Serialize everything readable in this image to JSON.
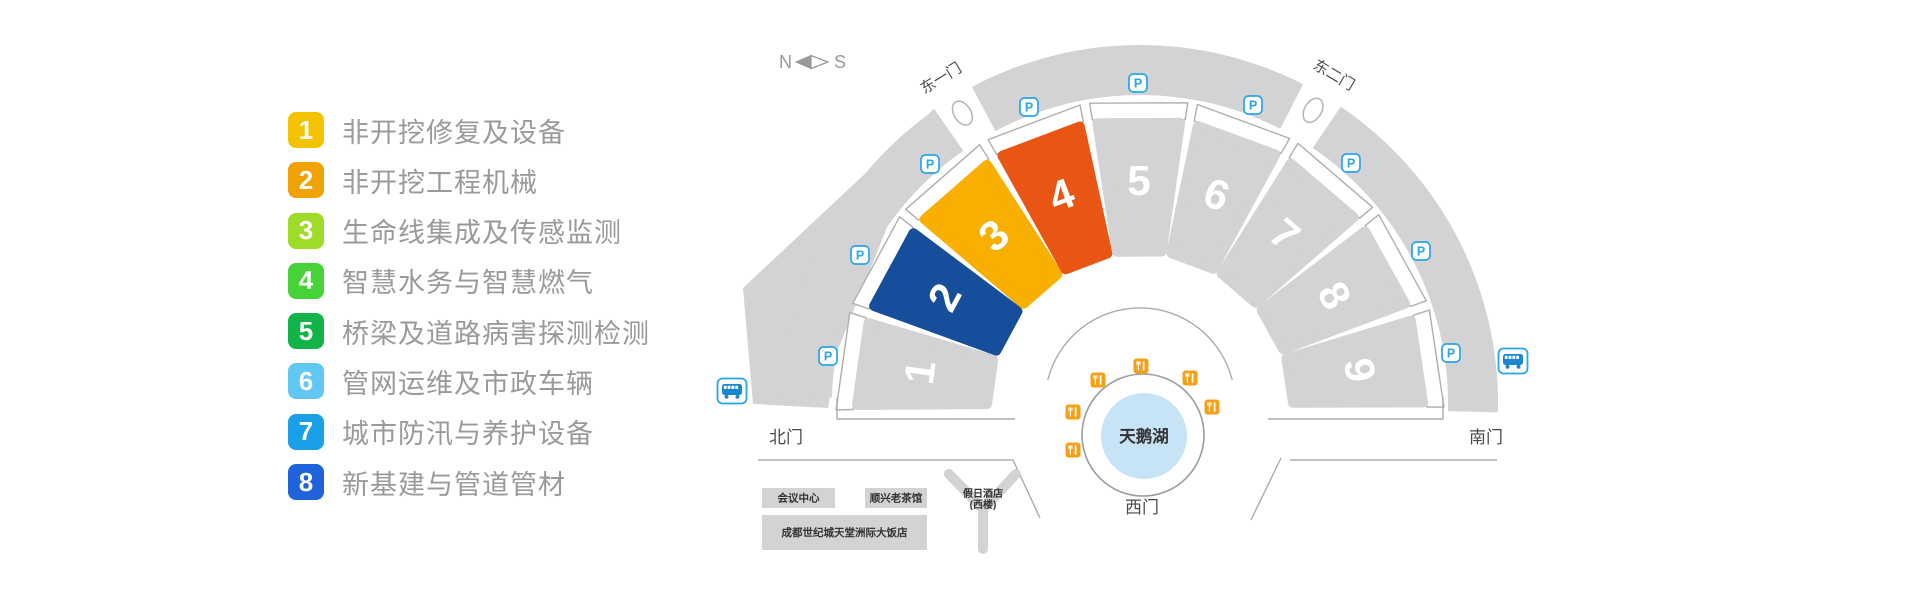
{
  "legend": {
    "items": [
      {
        "num": "1",
        "label": "非开挖修复及设备",
        "color": "#F3C200"
      },
      {
        "num": "2",
        "label": "非开挖工程机械",
        "color": "#F0A200"
      },
      {
        "num": "3",
        "label": "生命线集成及传感监测",
        "color": "#9EDC29"
      },
      {
        "num": "4",
        "label": "智慧水务与智慧燃气",
        "color": "#46D337"
      },
      {
        "num": "5",
        "label": "桥梁及道路病害探测检测",
        "color": "#12B44A"
      },
      {
        "num": "6",
        "label": "管网运维及市政车辆",
        "color": "#60C8F2"
      },
      {
        "num": "7",
        "label": "城市防汛与养护设备",
        "color": "#1A9FE9"
      },
      {
        "num": "8",
        "label": "新基建与管道管材",
        "color": "#1E63DC"
      }
    ]
  },
  "compass": {
    "north": "N",
    "south": "S"
  },
  "map": {
    "halls": [
      {
        "num": "1",
        "color": null
      },
      {
        "num": "2",
        "color": "#174E9B"
      },
      {
        "num": "3",
        "color": "#F8AF00"
      },
      {
        "num": "4",
        "color": "#E95513"
      },
      {
        "num": "5",
        "color": null
      },
      {
        "num": "6",
        "color": null
      },
      {
        "num": "7",
        "color": null
      },
      {
        "num": "8",
        "color": null
      },
      {
        "num": "9",
        "color": null
      }
    ],
    "hall_gray": "#D3D3D5",
    "gates": {
      "east1": "东一门",
      "east2": "东二门",
      "north": "北门",
      "south": "南门",
      "west": "西门"
    },
    "lake_label": "天鹅湖",
    "lake_color": "#C7E4F7",
    "parking_label": "P",
    "parking_color": "#2AA5E6",
    "restaurant_color": "#F5A118",
    "bus_color": "#1C87CE",
    "parking_spots": [
      [
        860,
        255
      ],
      [
        828,
        356
      ],
      [
        930,
        164
      ],
      [
        1029,
        107
      ],
      [
        1138,
        83
      ],
      [
        1253,
        105
      ],
      [
        1351,
        163
      ],
      [
        1421,
        251
      ],
      [
        1451,
        353
      ]
    ],
    "restaurant_spots": [
      [
        1141,
        366
      ],
      [
        1098,
        380
      ],
      [
        1190,
        378
      ],
      [
        1073,
        412
      ],
      [
        1212,
        407
      ],
      [
        1073,
        450
      ]
    ],
    "bus_stops": [
      [
        732,
        391
      ],
      [
        1513,
        361
      ]
    ],
    "buildings": [
      {
        "label": "会议中心",
        "x": 762,
        "y": 488,
        "w": 73,
        "h": 20
      },
      {
        "label": "顺兴老茶馆",
        "x": 865,
        "y": 488,
        "w": 62,
        "h": 20
      },
      {
        "label": "成都世纪城天堂洲际大饭店",
        "x": 762,
        "y": 515,
        "w": 165,
        "h": 35
      }
    ],
    "holiday_inn": {
      "line1": "假日酒店",
      "line2": "(西楼)"
    }
  }
}
